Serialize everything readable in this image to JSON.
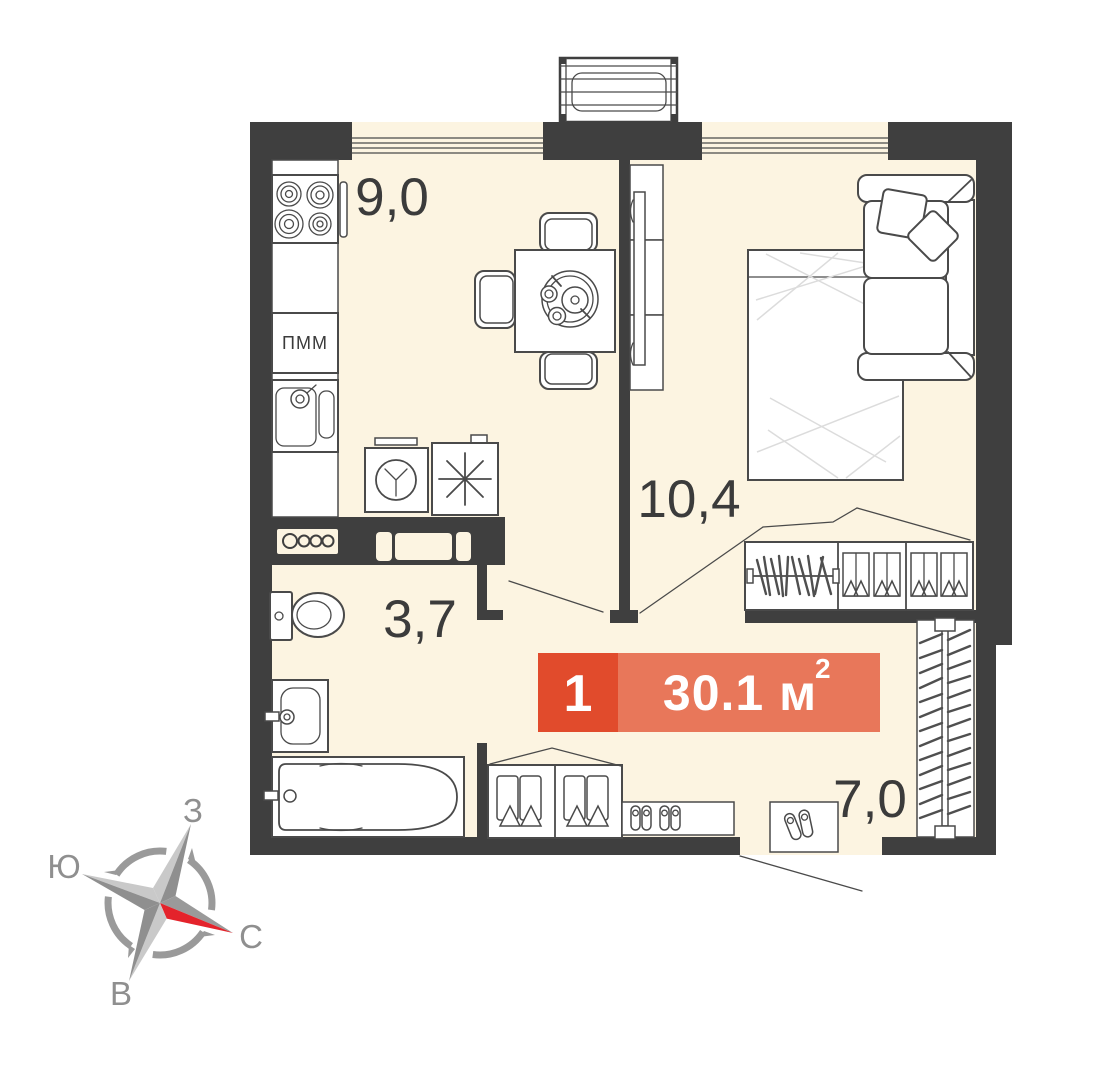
{
  "floorplan": {
    "title_badge": {
      "rooms_count": "1",
      "area_text": "30.1 м",
      "area_superscript": "2",
      "left_bg": "#e14b2c",
      "right_bg": "#e8775a"
    },
    "rooms": [
      {
        "name": "kitchen",
        "area": "9,0"
      },
      {
        "name": "living-room",
        "area": "10,4"
      },
      {
        "name": "bathroom",
        "area": "3,7"
      },
      {
        "name": "hallway",
        "area": "7,0"
      }
    ],
    "appliance_labels": {
      "dishwasher": "ПММ"
    },
    "compass": {
      "west": "З",
      "south": "Ю",
      "north": "С",
      "east": "В",
      "north_arrow_color": "#e4232b"
    },
    "palette": {
      "wall": "#3f3f3f",
      "floor": "#fcf4e1",
      "line": "#4a4a4a"
    }
  }
}
